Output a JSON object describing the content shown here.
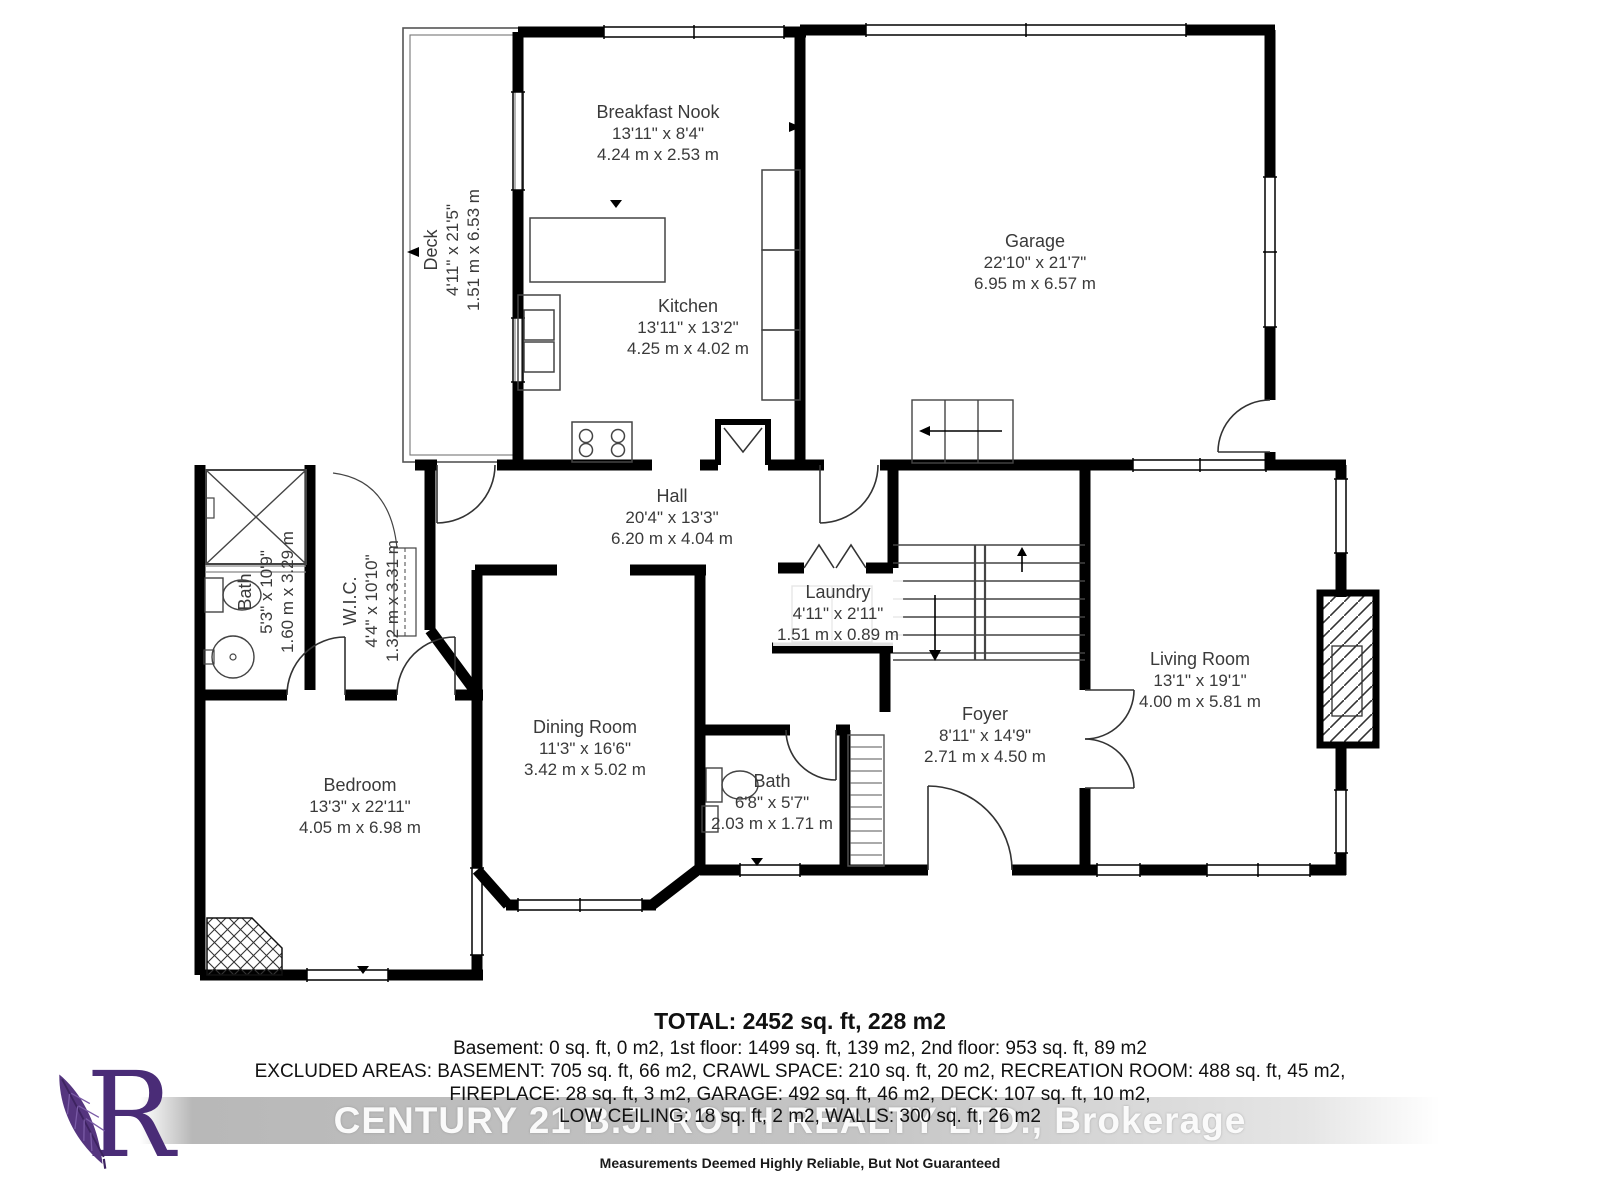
{
  "rooms": {
    "breakfast_nook": {
      "name": "Breakfast Nook",
      "imperial": "13'11\" x 8'4\"",
      "metric": "4.24 m x 2.53 m"
    },
    "kitchen": {
      "name": "Kitchen",
      "imperial": "13'11\" x 13'2\"",
      "metric": "4.25 m x 4.02 m"
    },
    "garage": {
      "name": "Garage",
      "imperial": "22'10\" x 21'7\"",
      "metric": "6.95 m x 6.57 m"
    },
    "deck": {
      "name": "Deck",
      "imperial": "4'11\" x 21'5\"",
      "metric": "1.51 m x 6.53 m"
    },
    "hall": {
      "name": "Hall",
      "imperial": "20'4\" x 13'3\"",
      "metric": "6.20 m x 4.04 m"
    },
    "bath_main": {
      "name": "Bath",
      "imperial": "5'3\" x 10'9\"",
      "metric": "1.60 m x 3.29 m"
    },
    "wic": {
      "name": "W.I.C.",
      "imperial": "4'4\" x 10'10\"",
      "metric": "1.32 m x 3.31 m"
    },
    "laundry": {
      "name": "Laundry",
      "imperial": "4'11\" x 2'11\"",
      "metric": "1.51 m x 0.89 m"
    },
    "living_room": {
      "name": "Living Room",
      "imperial": "13'1\" x 19'1\"",
      "metric": "4.00 m x 5.81 m"
    },
    "dining_room": {
      "name": "Dining Room",
      "imperial": "11'3\" x 16'6\"",
      "metric": "3.42 m x 5.02 m"
    },
    "bedroom": {
      "name": "Bedroom",
      "imperial": "13'3\" x 22'11\"",
      "metric": "4.05 m x 6.98 m"
    },
    "foyer": {
      "name": "Foyer",
      "imperial": "8'11\" x 14'9\"",
      "metric": "2.71 m x 4.50 m"
    },
    "bath_small": {
      "name": "Bath",
      "imperial": "6'8\" x 5'7\"",
      "metric": "2.03 m x 1.71 m"
    }
  },
  "summary": {
    "total": "TOTAL: 2452 sq. ft, 228 m2",
    "lines": [
      "Basement: 0 sq. ft, 0 m2, 1st floor: 1499 sq. ft, 139 m2, 2nd floor: 953 sq. ft, 89 m2",
      "EXCLUDED AREAS: BASEMENT: 705 sq. ft, 66 m2, CRAWL SPACE: 210 sq. ft, 20 m2, RECREATION ROOM: 488 sq. ft, 45 m2,",
      "FIREPLACE: 28 sq. ft, 3 m2, GARAGE: 492 sq. ft, 46 m2, DECK: 107 sq. ft, 10 m2,",
      "LOW CEILING: 18 sq. ft, 2 m2, WALLS: 300 sq. ft, 26 m2"
    ]
  },
  "watermark": "CENTURY 21 B.J. ROTH REALTY LTD., Brokerage",
  "disclaimer": "Measurements Deemed Highly Reliable, But Not Guaranteed",
  "logo": {
    "letter": "R",
    "color": "#4a2c77"
  },
  "colors": {
    "wall": "#000000",
    "label_text": "#3a3a3a",
    "background": "#ffffff",
    "watermark_text": "#fafafa"
  }
}
